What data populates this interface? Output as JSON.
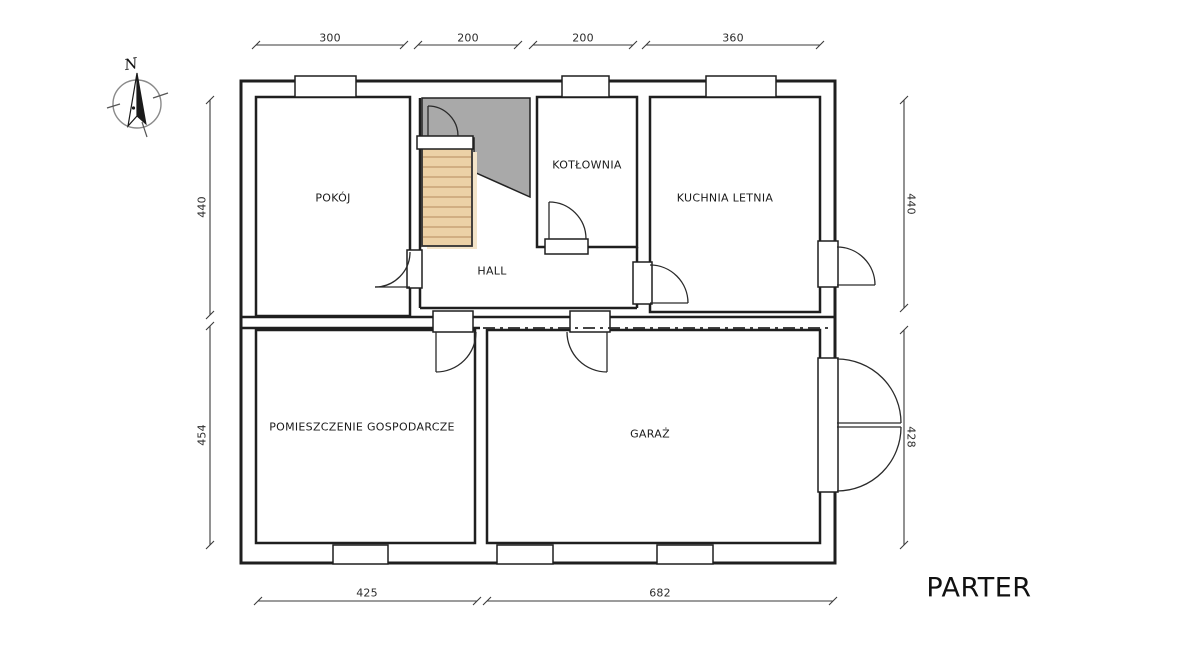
{
  "title": "PARTER",
  "compass": {
    "north_label": "N"
  },
  "rooms": [
    {
      "label": "POKÓJ"
    },
    {
      "label": "KOTŁOWNIA"
    },
    {
      "label": "KUCHNIA LETNIA"
    },
    {
      "label": "HALL"
    },
    {
      "label": "POMIESZCZENIE GOSPODARCZE"
    },
    {
      "label": "GARAŻ"
    }
  ],
  "dims": {
    "top": [
      "300",
      "200",
      "200",
      "360"
    ],
    "left": [
      "440",
      "454"
    ],
    "right": [
      "440",
      "428"
    ],
    "bottom": [
      "425",
      "682"
    ]
  },
  "colors": {
    "wall": "#1f1f1f",
    "stairs_fill": "#ecd1a6",
    "stairs_shadow": "#f3e4c9",
    "stairs_tread": "#c8a376",
    "shaded_area": "#a9a9a9",
    "dim_line": "#3a3a3a",
    "background": "#ffffff"
  }
}
